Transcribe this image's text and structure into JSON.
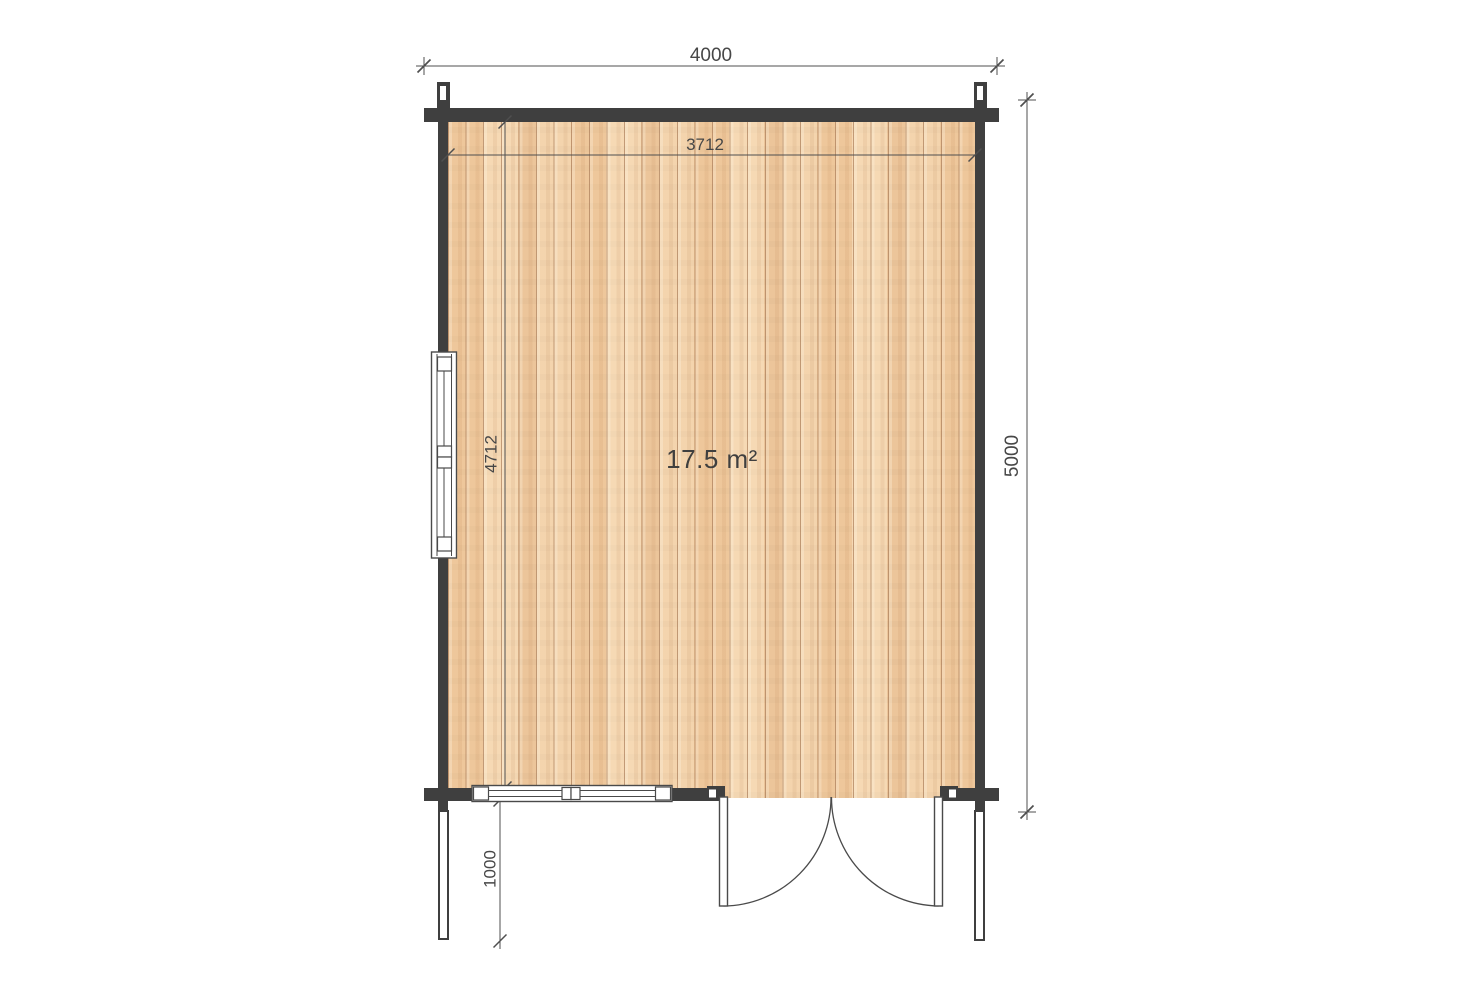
{
  "drawing": {
    "type": "floor-plan",
    "area_label": "17.5 m²",
    "dims": {
      "overall_width": "4000",
      "overall_depth": "5000",
      "interior_width": "3712",
      "interior_depth": "4712",
      "porch_depth": "1000"
    },
    "features": {
      "door": "double-door-bottom-right",
      "windows": [
        "left-wall-window",
        "front-wall-window"
      ]
    },
    "colors": {
      "wall": "#3f3f3f",
      "dimension_line": "#4f4f4f",
      "floor_base": "#f2d0a8",
      "floor_seam": "#b98c63",
      "background": "#ffffff"
    }
  }
}
